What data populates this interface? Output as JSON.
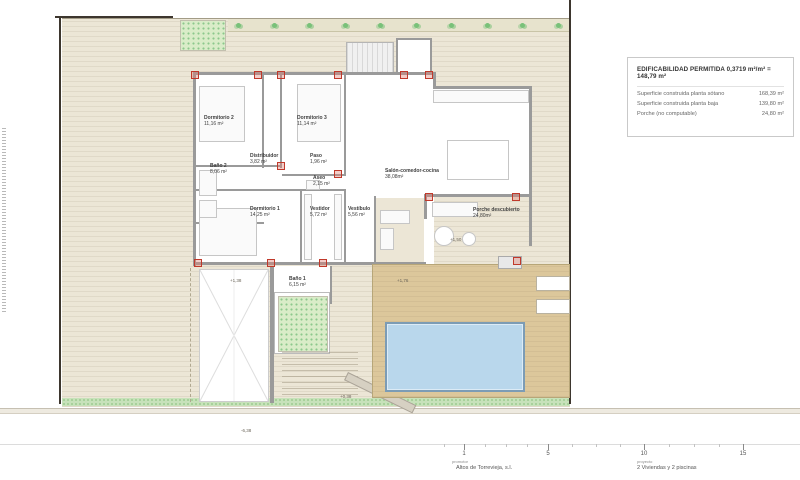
{
  "legend": {
    "title": "EDIFICABILIDAD PERMITIDA 0,3719 m²/m² = 148,79 m²",
    "rows": [
      {
        "label": "Superficie construida planta sótano",
        "value": "168,39 m²"
      },
      {
        "label": "Superficie construida planta baja",
        "value": "139,80 m²"
      },
      {
        "label": "Porche (no computable)",
        "value": "24,80 m²"
      }
    ]
  },
  "rooms": [
    {
      "name": "Dormitorio 2",
      "area": "11,16 m²"
    },
    {
      "name": "Dormitorio 3",
      "area": "11,14 m²"
    },
    {
      "name": "Baño 2",
      "area": "8,06 m²"
    },
    {
      "name": "Distribuidor",
      "area": "3,82 m²"
    },
    {
      "name": "Paso",
      "area": "1,96 m²"
    },
    {
      "name": "Aseo",
      "area": "2,15 m²"
    },
    {
      "name": "Dormitorio 1",
      "area": "14,25 m²"
    },
    {
      "name": "Vestidor",
      "area": "5,72 m²"
    },
    {
      "name": "Vestíbulo",
      "area": "5,56 m²"
    },
    {
      "name": "Salón-comedor-cocina",
      "area": "38,08m²"
    },
    {
      "name": "Porche descubierto",
      "area": "24,80m²"
    },
    {
      "name": "Baño 1",
      "area": "6,15 m²"
    }
  ],
  "levels": [
    "+1,38",
    "+1,76",
    "+1,50",
    "+0,38",
    "-6,38"
  ],
  "scalebar": {
    "ticks": [
      "1",
      "5",
      "10",
      "15"
    ]
  },
  "titleblock": {
    "promotor_label": "promotor",
    "promotor": "Altos de Torrevieja, s.l.",
    "proyecto_label": "proyecto",
    "proyecto": "2 Viviendas y 2 piscinas"
  },
  "colors": {
    "plot_beige": "#ece6d6",
    "deck_tan": "#dcc79b",
    "pool_blue": "#b9d7ec",
    "grass_green": "#c7e2ba",
    "tree_green": "#d9ecc8",
    "wall_gray": "#9a9a9a",
    "pillar_red": "#c0392b",
    "boundary_dark": "#3d362e"
  }
}
